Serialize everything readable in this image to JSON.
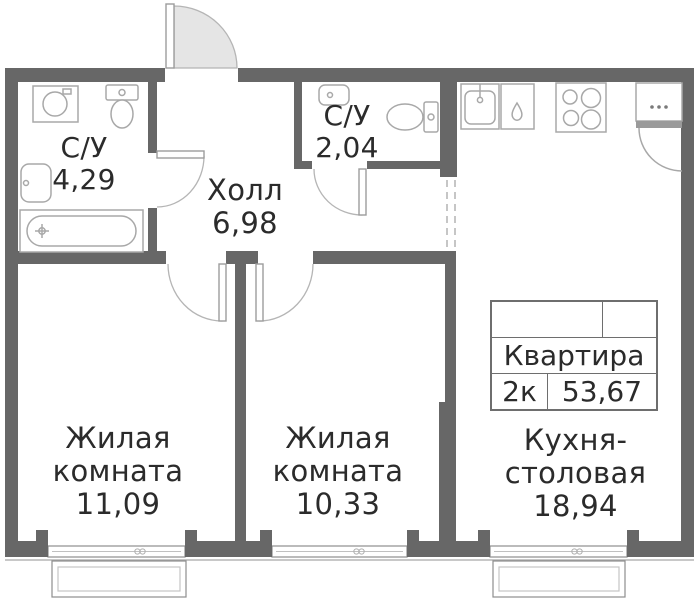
{
  "rooms": {
    "bathroom1": {
      "name": "С/У",
      "area": "4,29"
    },
    "bathroom2": {
      "name": "С/У",
      "area": "2,04"
    },
    "hall": {
      "name": "Холл",
      "area": "6,98"
    },
    "living1": {
      "line1": "Жилая",
      "line2": "комната",
      "area": "11,09"
    },
    "living2": {
      "line1": "Жилая",
      "line2": "комната",
      "area": "10,33"
    },
    "kitchen": {
      "line1": "Кухня-",
      "line2": "столовая",
      "area": "18,94"
    }
  },
  "table": {
    "title": "Квартира",
    "rooms": "2к",
    "area": "53,67"
  },
  "icons": [
    "entrance-door-icon",
    "bathroom1-door-icon",
    "bathroom2-door-icon",
    "living1-door-icon",
    "living2-door-icon",
    "kitchen-cabinet-door-icon",
    "washing-machine-icon",
    "toilet-icon",
    "sink-icon",
    "bathtub-icon",
    "kitchen-sink-icon",
    "dishwasher-icon",
    "stove-icon",
    "fridge-icon",
    "window-icon",
    "balcony-icon"
  ],
  "colors": {
    "wall": "#676767",
    "fixture_line": "#a8a8a8",
    "door_line": "#b5b5b5",
    "door_fill": "#e5e5e5",
    "text": "#2b2b2b",
    "frame": "#8e8e8e",
    "background": "#ffffff"
  }
}
